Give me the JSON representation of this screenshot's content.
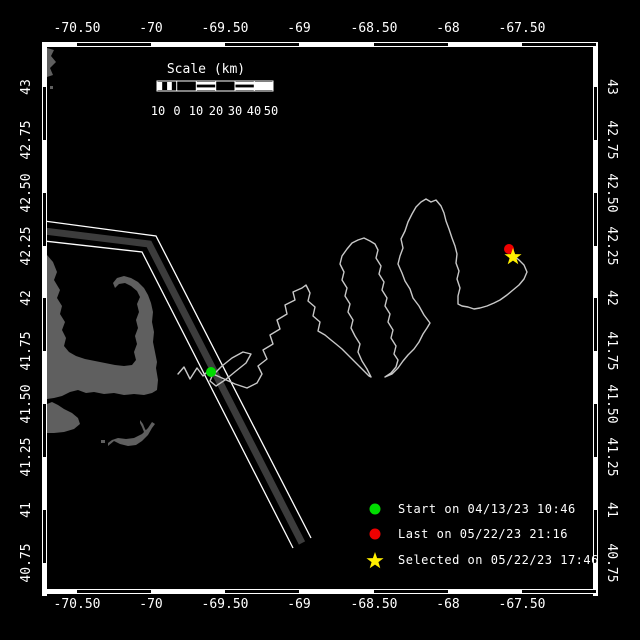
{
  "window": {
    "width": 640,
    "height": 640,
    "background": "#000000"
  },
  "map": {
    "frame": {
      "x0": 44,
      "y0": 44,
      "x1": 596,
      "y1": 594
    },
    "lon_axis": {
      "labels": [
        "-70.50",
        "-70",
        "-69.50",
        "-69",
        "-68.50",
        "-68",
        "-67.50"
      ],
      "x": [
        77,
        151,
        225,
        299,
        374,
        448,
        522
      ]
    },
    "lat_axis": {
      "labels": [
        "43",
        "42.75",
        "42.50",
        "42.25",
        "42",
        "41.75",
        "41.50",
        "41.25",
        "41",
        "40.75"
      ],
      "y": [
        87,
        140,
        193,
        246,
        298,
        351,
        404,
        457,
        510,
        563
      ]
    }
  },
  "scale_bar": {
    "title": "Scale (km)",
    "numbers": [
      "10",
      "0",
      "10",
      "20",
      "30",
      "40",
      "50"
    ],
    "number_x": [
      158,
      177,
      196,
      216,
      235,
      254,
      271
    ],
    "number_y": 104
  },
  "legend": {
    "items": [
      {
        "marker": "circle",
        "color": "#00dd00",
        "label": "Start on 04/13/23 10:46"
      },
      {
        "marker": "circle",
        "color": "#ee0000",
        "label": "Last on 05/22/23 21:16"
      },
      {
        "marker": "star",
        "color": "#ffee00",
        "label": "Selected on 05/22/23 17:46"
      }
    ]
  },
  "track": {
    "color": "#c8c8c8",
    "points": [
      [
        178,
        374
      ],
      [
        184,
        367
      ],
      [
        190,
        379
      ],
      [
        197,
        368
      ],
      [
        203,
        376
      ],
      [
        209,
        370
      ],
      [
        214,
        374
      ],
      [
        222,
        366
      ],
      [
        232,
        358
      ],
      [
        243,
        352
      ],
      [
        251,
        354
      ],
      [
        246,
        363
      ],
      [
        236,
        371
      ],
      [
        225,
        380
      ],
      [
        216,
        386
      ],
      [
        210,
        381
      ],
      [
        213,
        374
      ],
      [
        222,
        378
      ],
      [
        235,
        384
      ],
      [
        247,
        388
      ],
      [
        257,
        383
      ],
      [
        262,
        374
      ],
      [
        258,
        366
      ],
      [
        267,
        359
      ],
      [
        263,
        350
      ],
      [
        273,
        344
      ],
      [
        270,
        335
      ],
      [
        280,
        329
      ],
      [
        277,
        320
      ],
      [
        287,
        314
      ],
      [
        285,
        305
      ],
      [
        295,
        300
      ],
      [
        293,
        292
      ],
      [
        302,
        288
      ],
      [
        306,
        285
      ],
      [
        310,
        293
      ],
      [
        308,
        301
      ],
      [
        315,
        307
      ],
      [
        313,
        316
      ],
      [
        320,
        322
      ],
      [
        318,
        331
      ],
      [
        325,
        335
      ],
      [
        331,
        340
      ],
      [
        336,
        344
      ],
      [
        342,
        349
      ],
      [
        348,
        355
      ],
      [
        354,
        361
      ],
      [
        359,
        366
      ],
      [
        364,
        371
      ],
      [
        369,
        376
      ],
      [
        371,
        377
      ],
      [
        367,
        369
      ],
      [
        362,
        361
      ],
      [
        358,
        352
      ],
      [
        360,
        344
      ],
      [
        355,
        336
      ],
      [
        351,
        328
      ],
      [
        353,
        320
      ],
      [
        348,
        312
      ],
      [
        350,
        304
      ],
      [
        345,
        296
      ],
      [
        347,
        288
      ],
      [
        342,
        280
      ],
      [
        344,
        272
      ],
      [
        340,
        264
      ],
      [
        342,
        256
      ],
      [
        347,
        249
      ],
      [
        352,
        243
      ],
      [
        358,
        240
      ],
      [
        364,
        238
      ],
      [
        370,
        241
      ],
      [
        375,
        244
      ],
      [
        378,
        250
      ],
      [
        376,
        258
      ],
      [
        381,
        266
      ],
      [
        379,
        274
      ],
      [
        384,
        282
      ],
      [
        382,
        290
      ],
      [
        387,
        298
      ],
      [
        385,
        306
      ],
      [
        390,
        314
      ],
      [
        388,
        322
      ],
      [
        393,
        330
      ],
      [
        391,
        338
      ],
      [
        396,
        346
      ],
      [
        394,
        354
      ],
      [
        398,
        360
      ],
      [
        396,
        367
      ],
      [
        391,
        373
      ],
      [
        385,
        377
      ],
      [
        392,
        374
      ],
      [
        398,
        368
      ],
      [
        403,
        361
      ],
      [
        408,
        355
      ],
      [
        414,
        349
      ],
      [
        419,
        342
      ],
      [
        423,
        334
      ],
      [
        427,
        328
      ],
      [
        430,
        323
      ],
      [
        424,
        315
      ],
      [
        419,
        306
      ],
      [
        413,
        298
      ],
      [
        410,
        289
      ],
      [
        405,
        281
      ],
      [
        402,
        273
      ],
      [
        398,
        264
      ],
      [
        400,
        256
      ],
      [
        403,
        248
      ],
      [
        401,
        239
      ],
      [
        405,
        231
      ],
      [
        408,
        222
      ],
      [
        412,
        214
      ],
      [
        416,
        207
      ],
      [
        421,
        202
      ],
      [
        426,
        199
      ],
      [
        431,
        202
      ],
      [
        436,
        200
      ],
      [
        441,
        206
      ],
      [
        444,
        213
      ],
      [
        446,
        221
      ],
      [
        449,
        229
      ],
      [
        452,
        238
      ],
      [
        455,
        246
      ],
      [
        457,
        254
      ],
      [
        456,
        263
      ],
      [
        459,
        271
      ],
      [
        457,
        279
      ],
      [
        460,
        288
      ],
      [
        458,
        296
      ],
      [
        458,
        304
      ],
      [
        462,
        306
      ],
      [
        468,
        307
      ],
      [
        474,
        309
      ],
      [
        480,
        308
      ],
      [
        487,
        306
      ],
      [
        494,
        303
      ],
      [
        500,
        300
      ],
      [
        507,
        295
      ],
      [
        513,
        290
      ],
      [
        519,
        285
      ],
      [
        524,
        279
      ],
      [
        527,
        272
      ],
      [
        524,
        265
      ],
      [
        519,
        260
      ],
      [
        514,
        256
      ],
      [
        510,
        251
      ]
    ],
    "markers": {
      "start": {
        "x": 211,
        "y": 372
      },
      "last": {
        "x": 509,
        "y": 249
      },
      "selected": {
        "x": 513,
        "y": 257
      }
    }
  },
  "colors": {
    "background": "#000000",
    "frame": "#ffffff",
    "text": "#ffffff",
    "land": "#5f5f5f",
    "lane_band": "#3c3c3c",
    "lane_edge": "#ffffff",
    "track": "#c8c8c8",
    "start": "#00dd00",
    "last": "#ee0000",
    "selected": "#ffee00"
  }
}
